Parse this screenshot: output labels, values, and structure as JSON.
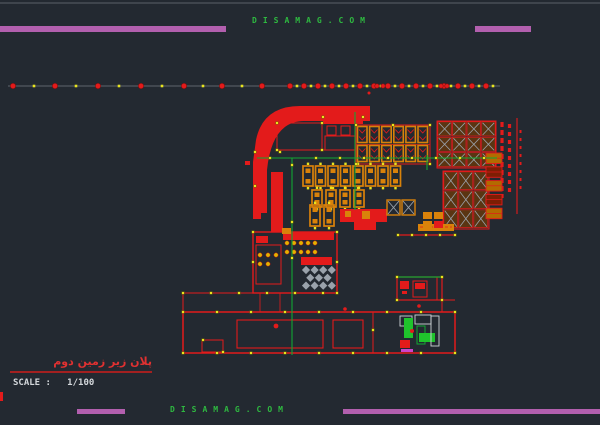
{
  "watermarks": {
    "top": "DISAMAG.COM",
    "bottom": "DISAMAG.COM"
  },
  "title_block": {
    "drawing_title": "پلان زیر زمین دوم",
    "scale_text": "SCALE :   1/100"
  },
  "colors": {
    "background": "#232931",
    "accent_purple": "#b25fae",
    "watermark_green": "#2eb940",
    "entity_red": "#e31b1b",
    "entity_orange": "#d9820a",
    "grip_yellow": "#e8e41f",
    "line_green": "#12a832",
    "hatch_gray": "#9aa2ab",
    "text_white": "#d3d7db",
    "title_red": "#e03131"
  }
}
